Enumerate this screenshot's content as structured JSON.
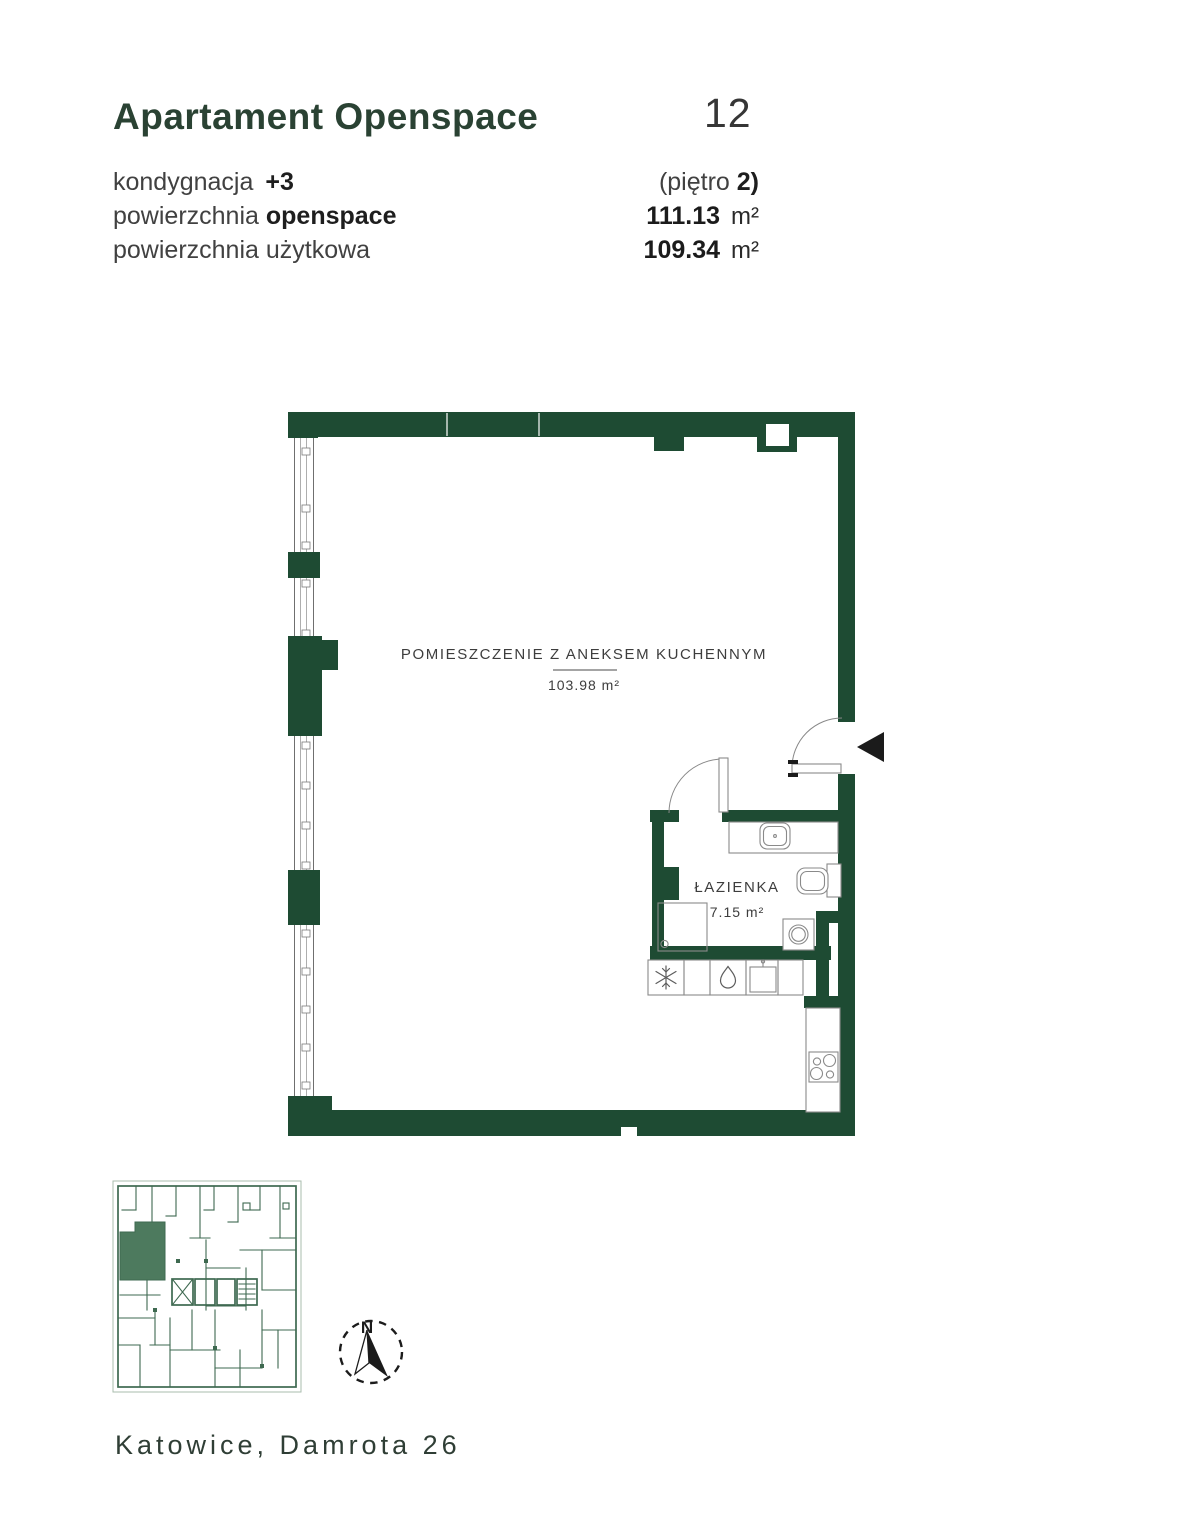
{
  "header": {
    "title": "Apartament Openspace",
    "unit_number": "12"
  },
  "info": {
    "row1": {
      "label": "kondygnacja",
      "label_strong": "+3",
      "value": "(piętro",
      "value_strong": "2)"
    },
    "row2": {
      "label": "powierzchnia",
      "label_strong": "openspace",
      "value_strong": "111.13",
      "unit": "m²"
    },
    "row3": {
      "label": "powierzchnia użytkowa",
      "value_strong": "109.34",
      "unit": "m²"
    }
  },
  "plan": {
    "main_room": {
      "name": "POMIESZCZENIE Z ANEKSEM KUCHENNYM",
      "area": "103.98 m²"
    },
    "bathroom": {
      "name": "ŁAZIENKA",
      "area": "7.15 m²"
    },
    "compass": {
      "label": "N"
    }
  },
  "footer": {
    "address": "Katowice, Damrota 26"
  },
  "colors": {
    "wall_green": "#1E4B33",
    "title_green": "#2A4233",
    "miniplan_wall": "#3E6950",
    "miniplan_highlight": "#4D7A5E",
    "text_dark": "#414141"
  }
}
